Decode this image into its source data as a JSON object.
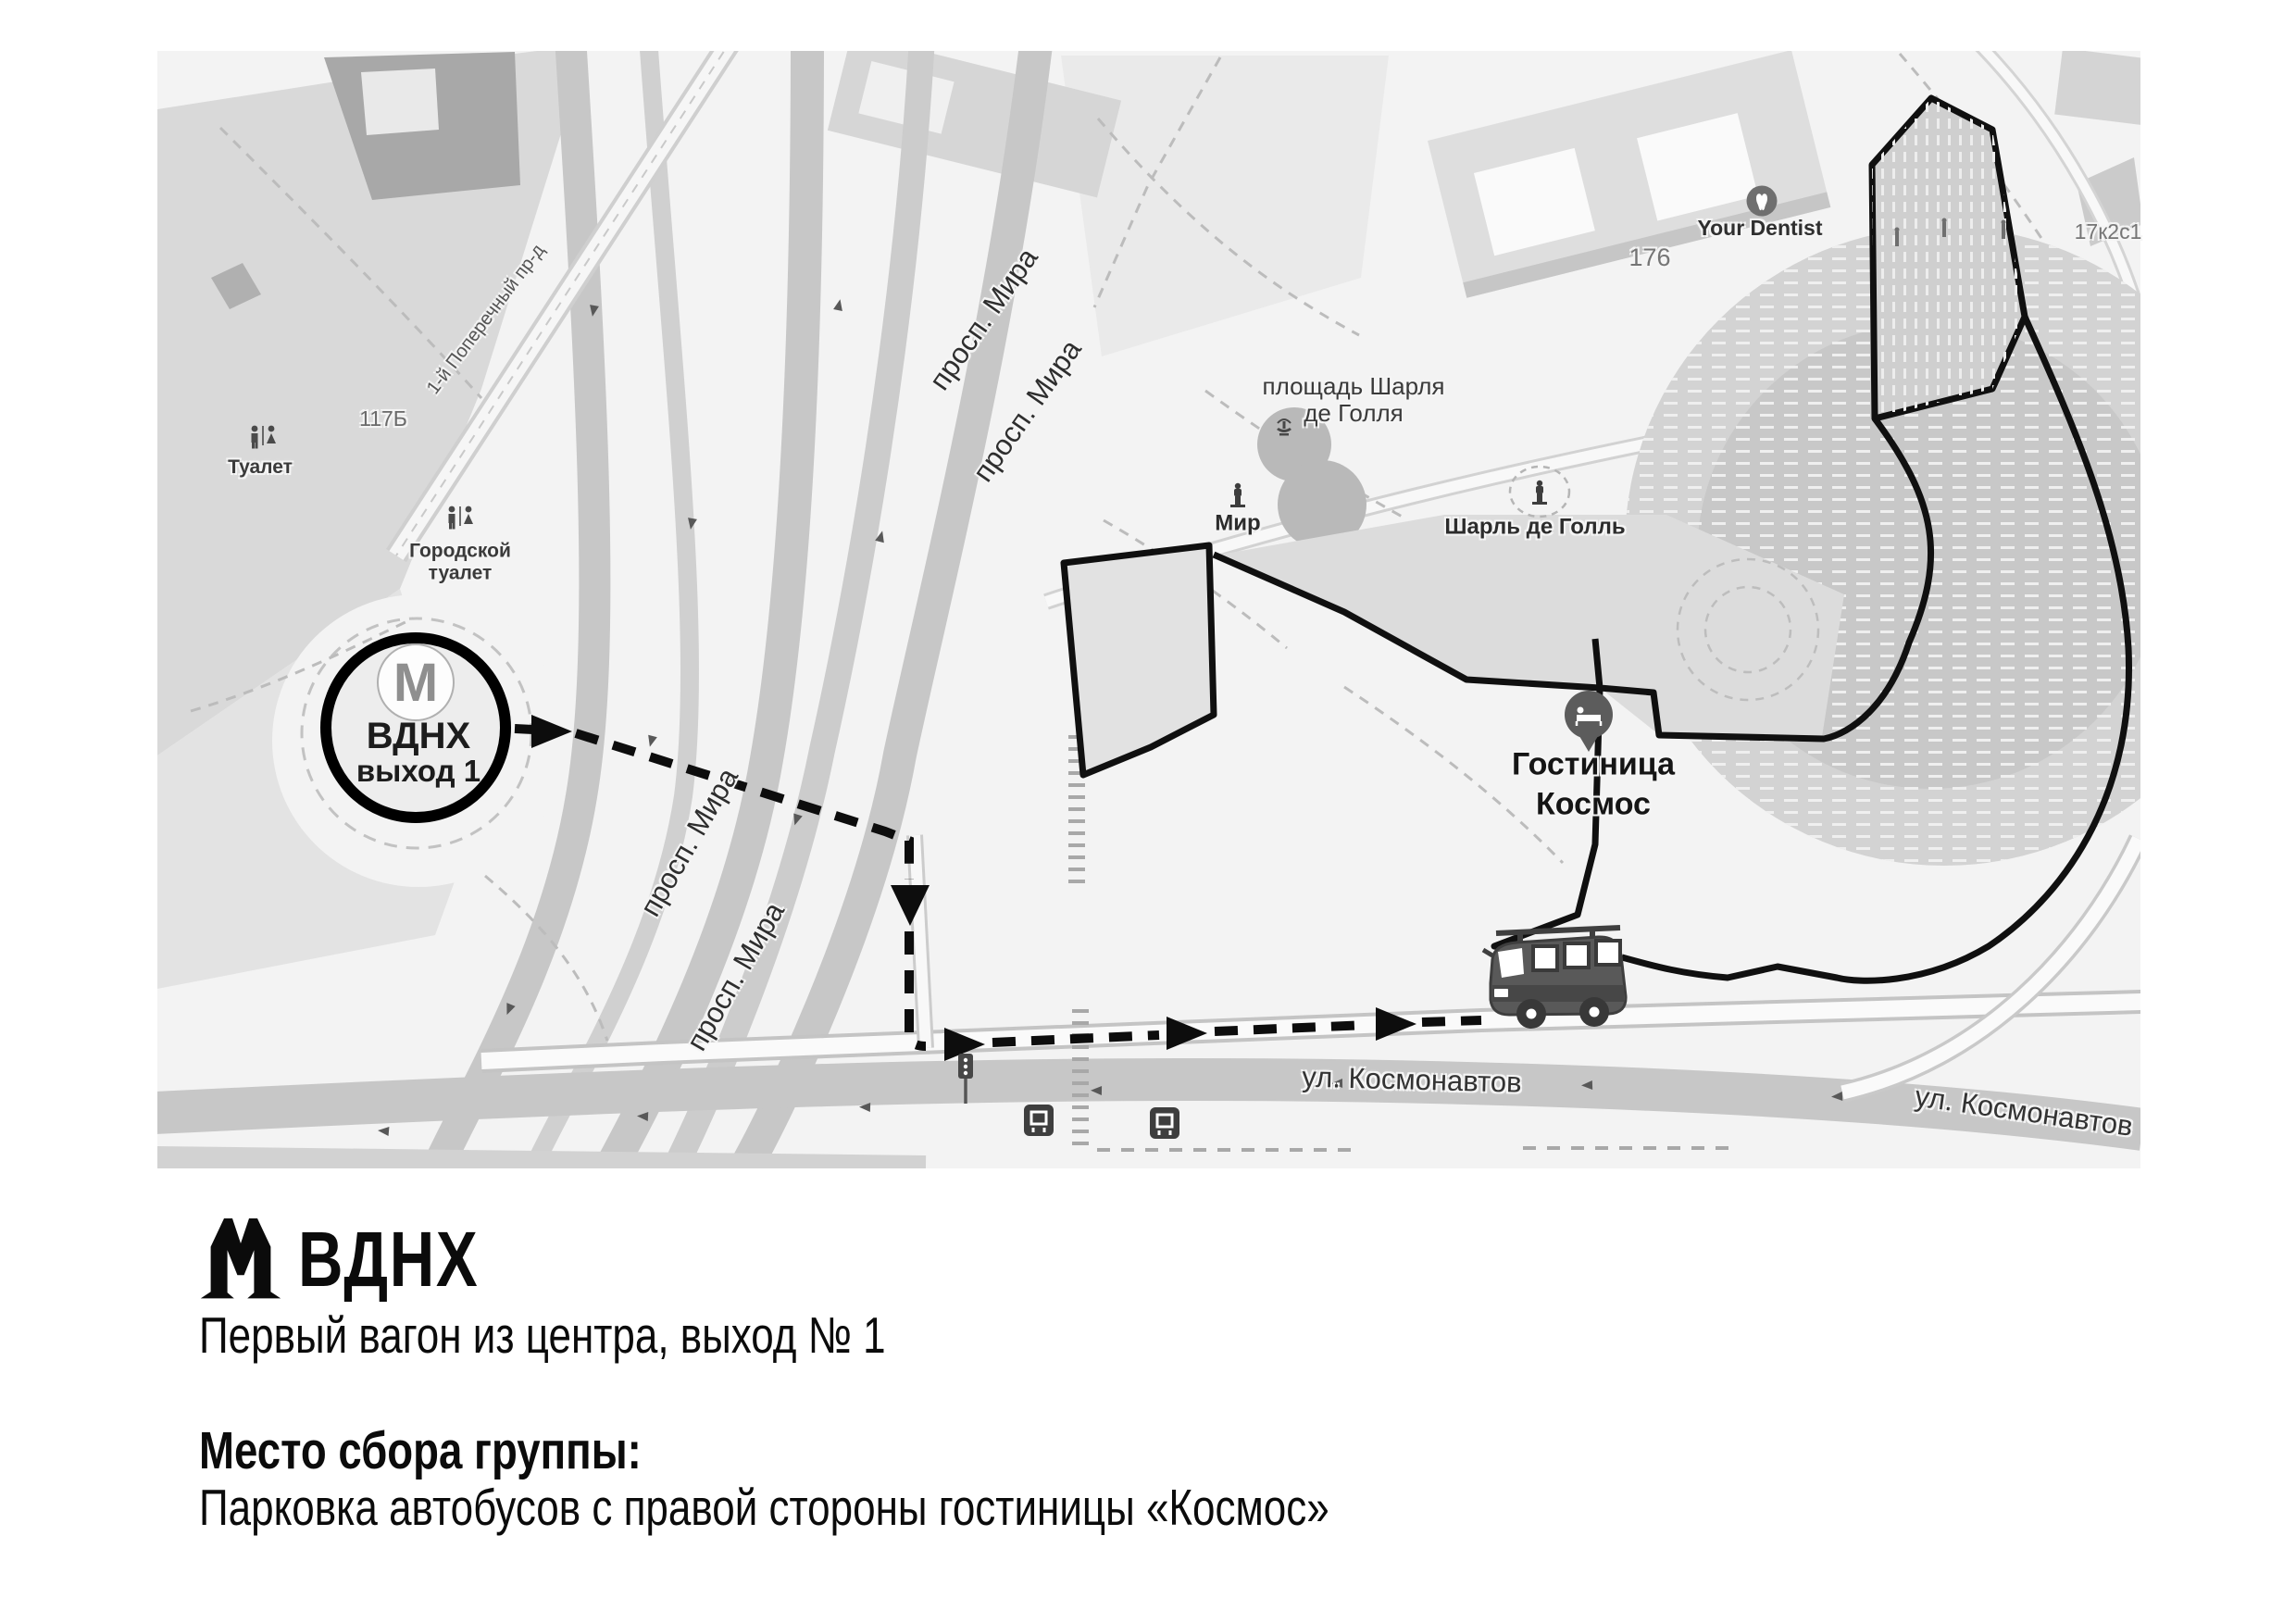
{
  "map": {
    "bg": "#f3f3f3",
    "labels": {
      "toilet": "Туалет",
      "city_toilet_1": "Городской",
      "city_toilet_2": "туалет",
      "house_117b": "117Б",
      "poperechny": "1-й Поперечный пр-д",
      "prosp_mira": "просп. Мира",
      "square_1": "площадь Шарля",
      "square_2": "де Голля",
      "mir": "Мир",
      "charles_de_gaulle": "Шарль де Голль",
      "your_dentist": "Your Dentist",
      "house_176": "176",
      "house_17k2s1": "17к2с1",
      "hotel_1": "Гостиница",
      "hotel_2": "Космос",
      "kosmonavtov": "ул. Космонавтов"
    },
    "metro_badge": {
      "letter": "М",
      "station": "ВДНХ",
      "exit": "выход 1"
    },
    "icons": {
      "metro_badge": "metro-m-icon",
      "wc": "wc-icon",
      "statue": "statue-icon",
      "fountain": "fountain-icon",
      "dentist": "tooth-icon",
      "hotel_pin": "hotel-bed-pin-icon",
      "bus": "bus-icon",
      "traffic_light": "traffic-light-icon",
      "transit_stop": "transit-stop-icon",
      "route_arrow": "route-arrow-icon"
    },
    "colors": {
      "route": "#0d0d0d",
      "outline": "#101010",
      "road": "#c7c7c7",
      "park": "#d9d9d9",
      "building": "#d6d6d6",
      "hotel_mass": "#d3d3d3"
    }
  },
  "caption": {
    "metro_letter": "М",
    "station": "ВДНХ",
    "subtitle": "Первый вагон из центра, выход № 1",
    "meeting_label": "Место сбора группы:",
    "meeting_value": "Парковка автобусов с правой стороны гостиницы «Космос»"
  }
}
